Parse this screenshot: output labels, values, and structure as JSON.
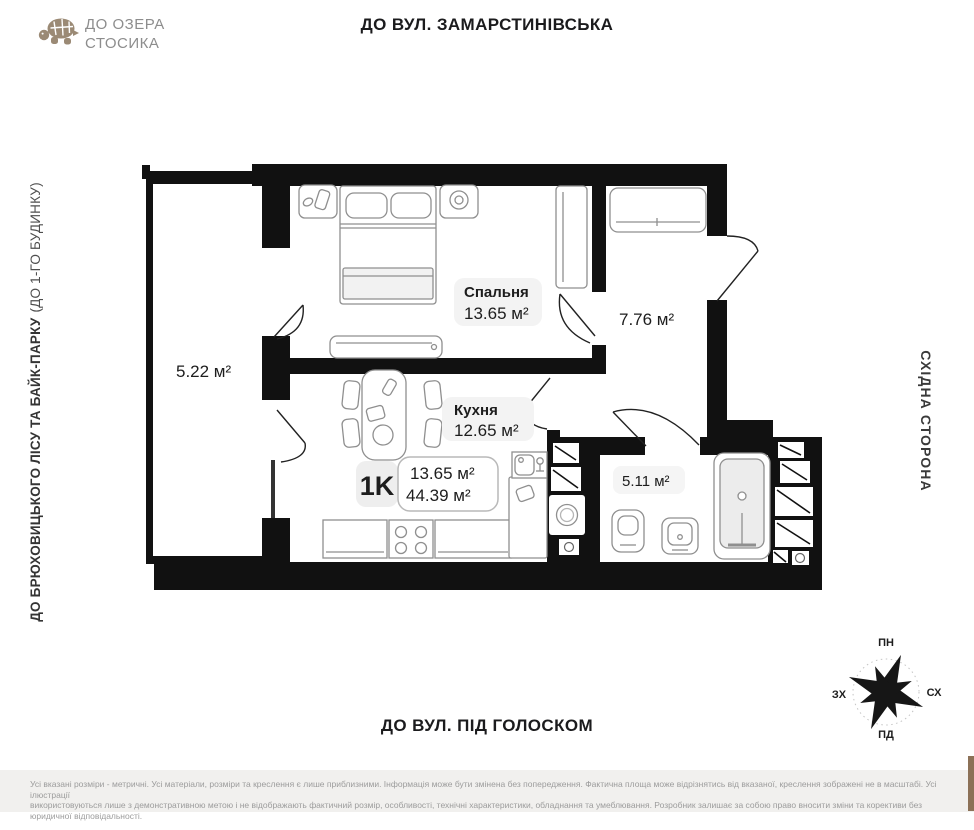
{
  "header": {
    "logo_line1": "ДО ОЗЕРА",
    "logo_line2": "СТОСИКА",
    "top_street": "ДО ВУЛ. ЗАМАРСТИНІВСЬКА"
  },
  "directions": {
    "left_main": "ДО БРЮХОВИЦЬКОГО ЛІСУ ТА БАЙК-ПАРКУ",
    "left_secondary": "(ДО 1-ГО БУДИНКУ)",
    "right_side": "СХІДНА СТОРОНА",
    "bottom_street": "ДО ВУЛ. ПІД ГОЛОСКОМ"
  },
  "plan": {
    "unit_label": "1K",
    "summary": {
      "living_area": "13.65 м²",
      "total_area": "44.39 м²"
    },
    "rooms": {
      "bedroom": {
        "name": "Спальня",
        "area": "13.65 м²"
      },
      "kitchen": {
        "name": "Кухня",
        "area": "12.65 м²"
      },
      "hall": {
        "area": "7.76 м²"
      },
      "bathroom": {
        "area": "5.11 м²"
      },
      "balcony": {
        "area": "5.22 м²"
      }
    }
  },
  "compass": {
    "n": "ПН",
    "e": "СХ",
    "w": "ЗХ",
    "s": "ПД"
  },
  "disclaimer": {
    "line1": "Усі вказані розміри - метричні. Усі матеріали, розміри та креслення є лише приблизними. Інформація може бути змінена без попередження. Фактична площа може відрізнятись від вказаної, креслення зображені не в масштабі. Усі ілюстрації",
    "line2": "використовуються лише з демонстративною метою і не відображають фактичний розмір, особливості, технічні характеристики, обладнання та умеблювання. Розробник залишає за собою право вносити зміни та корективи без юридичної відповідальності."
  },
  "colors": {
    "wall": "#111111",
    "logo": "#9b8a75",
    "badge_bg": "#f3f3f3"
  }
}
